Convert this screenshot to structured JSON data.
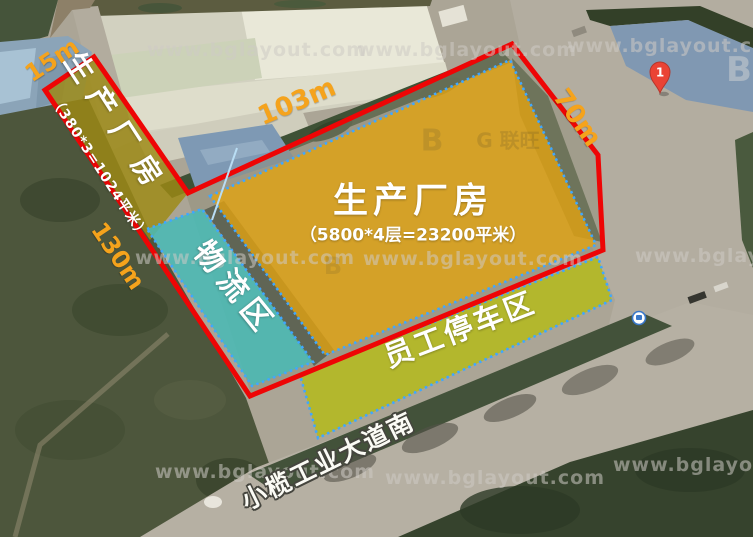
{
  "watermark": {
    "text": "www.bglayout.com"
  },
  "logo_watermark": {
    "marks": [
      "B",
      "G 联旺",
      "B",
      "B"
    ]
  },
  "zones": {
    "strip_building": {
      "label": "生产厂房",
      "area": "（380*3=1024平米）",
      "fill": "#9d8a14"
    },
    "main_building": {
      "label": "生产厂房",
      "area": "（5800*4层=23200平米）",
      "fill": "#e2a310"
    },
    "logistics": {
      "label": "物流区",
      "fill": "#48bab6"
    },
    "parking": {
      "label": "员工停车区",
      "fill": "#b5bd10"
    }
  },
  "dimensions": {
    "top_edge": "103m",
    "right_edge": "70m",
    "left_edge": "130m",
    "strip_edge": "15m"
  },
  "road": {
    "name": "小榄工业大道南"
  },
  "map_pin": {
    "label": "1"
  },
  "colors": {
    "boundary": "#ee0505",
    "zone_border": "#3fa7ff",
    "dimension_text": "#f5a31c",
    "road_surface": "#b6b0a3",
    "water": "#8ba4b8"
  }
}
